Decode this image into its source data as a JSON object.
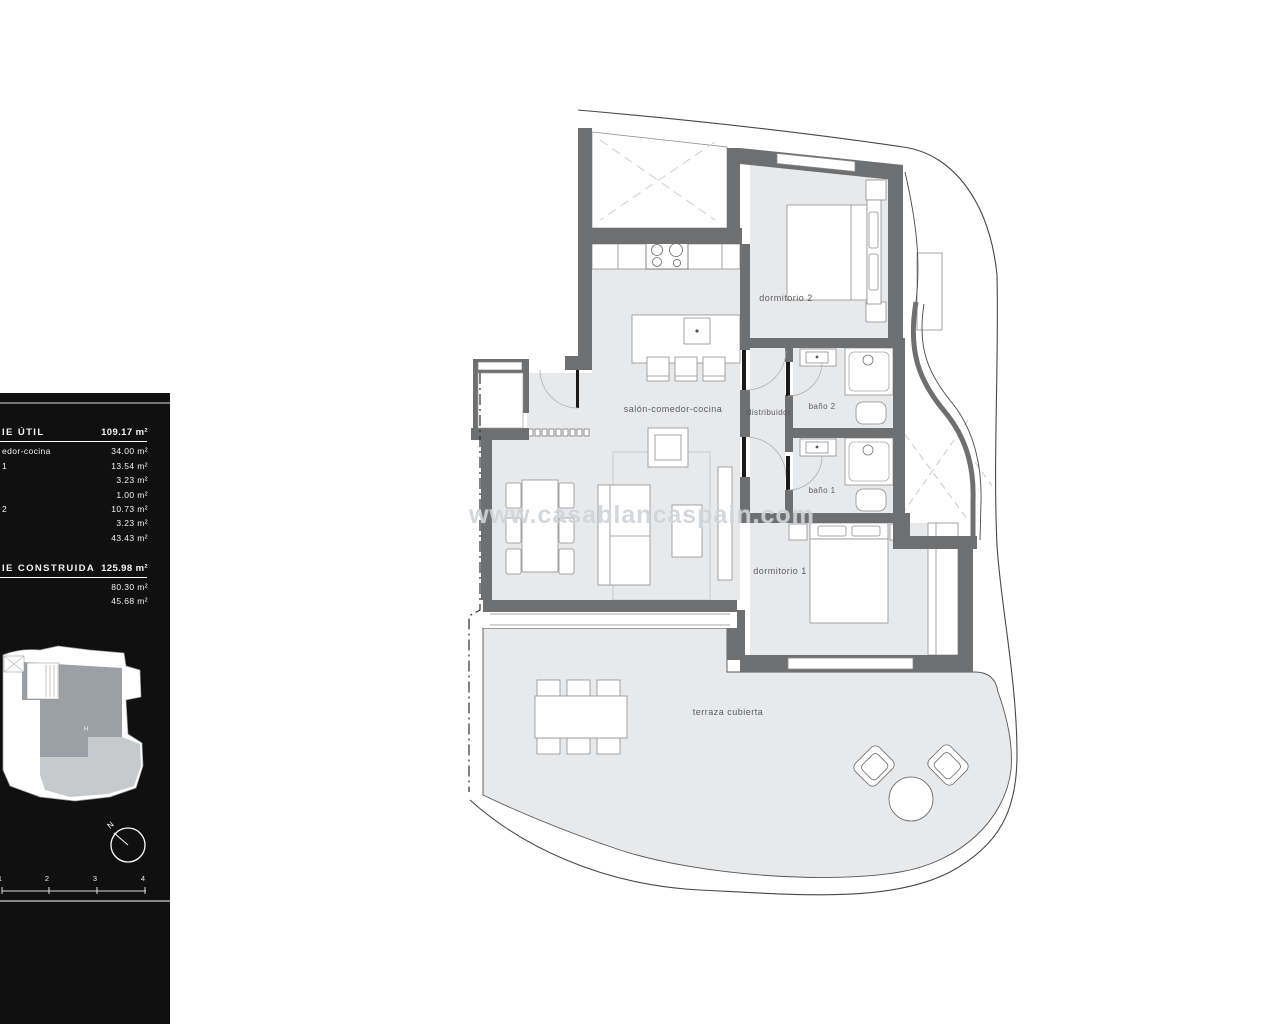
{
  "sidebar": {
    "util": {
      "label": "IE ÚTIL",
      "value": "109.17 m²",
      "rows": [
        {
          "label": "edor-cocina",
          "value": "34.00 m²"
        },
        {
          "label": "1",
          "value": "13.54 m²"
        },
        {
          "label": "",
          "value": "3.23 m²"
        },
        {
          "label": "",
          "value": "1.00 m²"
        },
        {
          "label": "2",
          "value": "10.73 m²"
        },
        {
          "label": "",
          "value": "3.23 m²"
        },
        {
          "label": "",
          "value": "43.43 m²"
        }
      ]
    },
    "construida": {
      "label": "IE CONSTRUIDA",
      "value": "125.98 m²",
      "rows": [
        {
          "label": "",
          "value": "80.30 m²"
        },
        {
          "label": "",
          "value": "45.68 m²"
        }
      ]
    },
    "keyplan": {
      "unit_label": "H"
    },
    "compass": {
      "north_label": "N"
    },
    "scalebar": {
      "labels": [
        "1",
        "2",
        "3",
        "4"
      ]
    }
  },
  "plan": {
    "rooms": {
      "salon": "salón-comedor-cocina",
      "dormitorio2": "dormitorio 2",
      "distribuidor": "distribuidor",
      "bano2": "baño 2",
      "bano1": "baño 1",
      "dormitorio1": "dormitorio 1",
      "terraza": "terraza cubierta"
    }
  },
  "watermark": {
    "text": "www.casablancaspain.com"
  },
  "colors": {
    "wall": "#6e6f71",
    "floor": "#e8e9eb",
    "sidebar_bg": "#101010",
    "keyplan_unit": "#9aa0a6",
    "keyplan_terrace": "#c6cacd"
  }
}
